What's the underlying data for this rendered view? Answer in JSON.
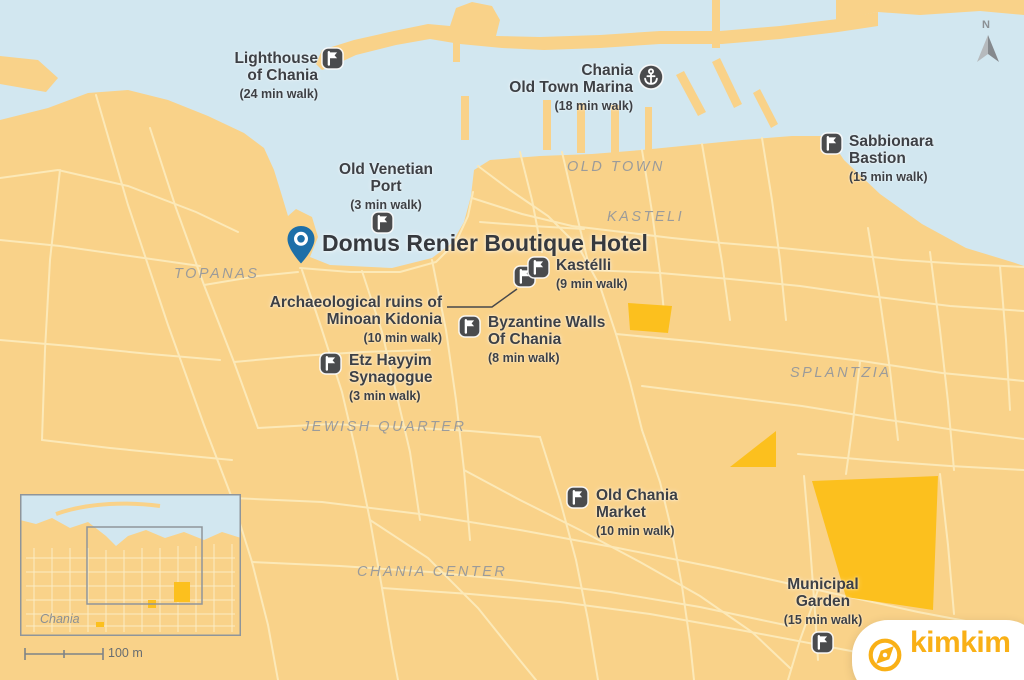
{
  "hotel": {
    "name": "Domus Renier Boutique Hotel",
    "marker": "blue-pin-icon"
  },
  "pois": [
    {
      "name": "Lighthouse\nof Chania",
      "walk": "(24 min walk)",
      "icon": "flag-icon"
    },
    {
      "name": "Chania\nOld Town Marina",
      "walk": "(18 min walk)",
      "icon": "anchor-icon"
    },
    {
      "name": "Sabbionara\nBastion",
      "walk": "(15 min walk)",
      "icon": "flag-icon"
    },
    {
      "name": "Old Venetian\nPort",
      "walk": "(3 min walk)",
      "icon": "flag-icon"
    },
    {
      "name": "Kastélli",
      "walk": "(9 min walk)",
      "icon": "flag-icon"
    },
    {
      "name": "Archaeological ruins of\nMinoan Kidonia",
      "walk": "(10 min walk)",
      "icon": "flag-icon"
    },
    {
      "name": "Byzantine Walls\nOf Chania",
      "walk": "(8 min walk)",
      "icon": "flag-icon"
    },
    {
      "name": "Etz Hayyim\nSynagogue",
      "walk": "(3 min walk)",
      "icon": "flag-icon"
    },
    {
      "name": "Old Chania\nMarket",
      "walk": "(10 min walk)",
      "icon": "flag-icon"
    },
    {
      "name": "Municipal\nGarden",
      "walk": "(15 min walk)",
      "icon": "flag-icon"
    }
  ],
  "regions": [
    {
      "text": "OLD TOWN"
    },
    {
      "text": "KASTELI"
    },
    {
      "text": "TOPANAS"
    },
    {
      "text": "SPLANTZIA"
    },
    {
      "text": "JEWISH QUARTER"
    },
    {
      "text": "CHANIA CENTER"
    }
  ],
  "inset": {
    "place_label": "Chania",
    "scale_label": "100 m"
  },
  "compass_label": "N",
  "logo_text": "kimkim",
  "colors": {
    "water": "#d2e7f0",
    "land": "#f9d289",
    "road": "#fce9b8",
    "park_orange": "#fcc01e",
    "marker_dark": "#4a4b4d",
    "pin_blue": "#1d6fa8",
    "brand_orange": "#f9b016",
    "label_text": "#3d4045",
    "region_text": "#97999b"
  }
}
